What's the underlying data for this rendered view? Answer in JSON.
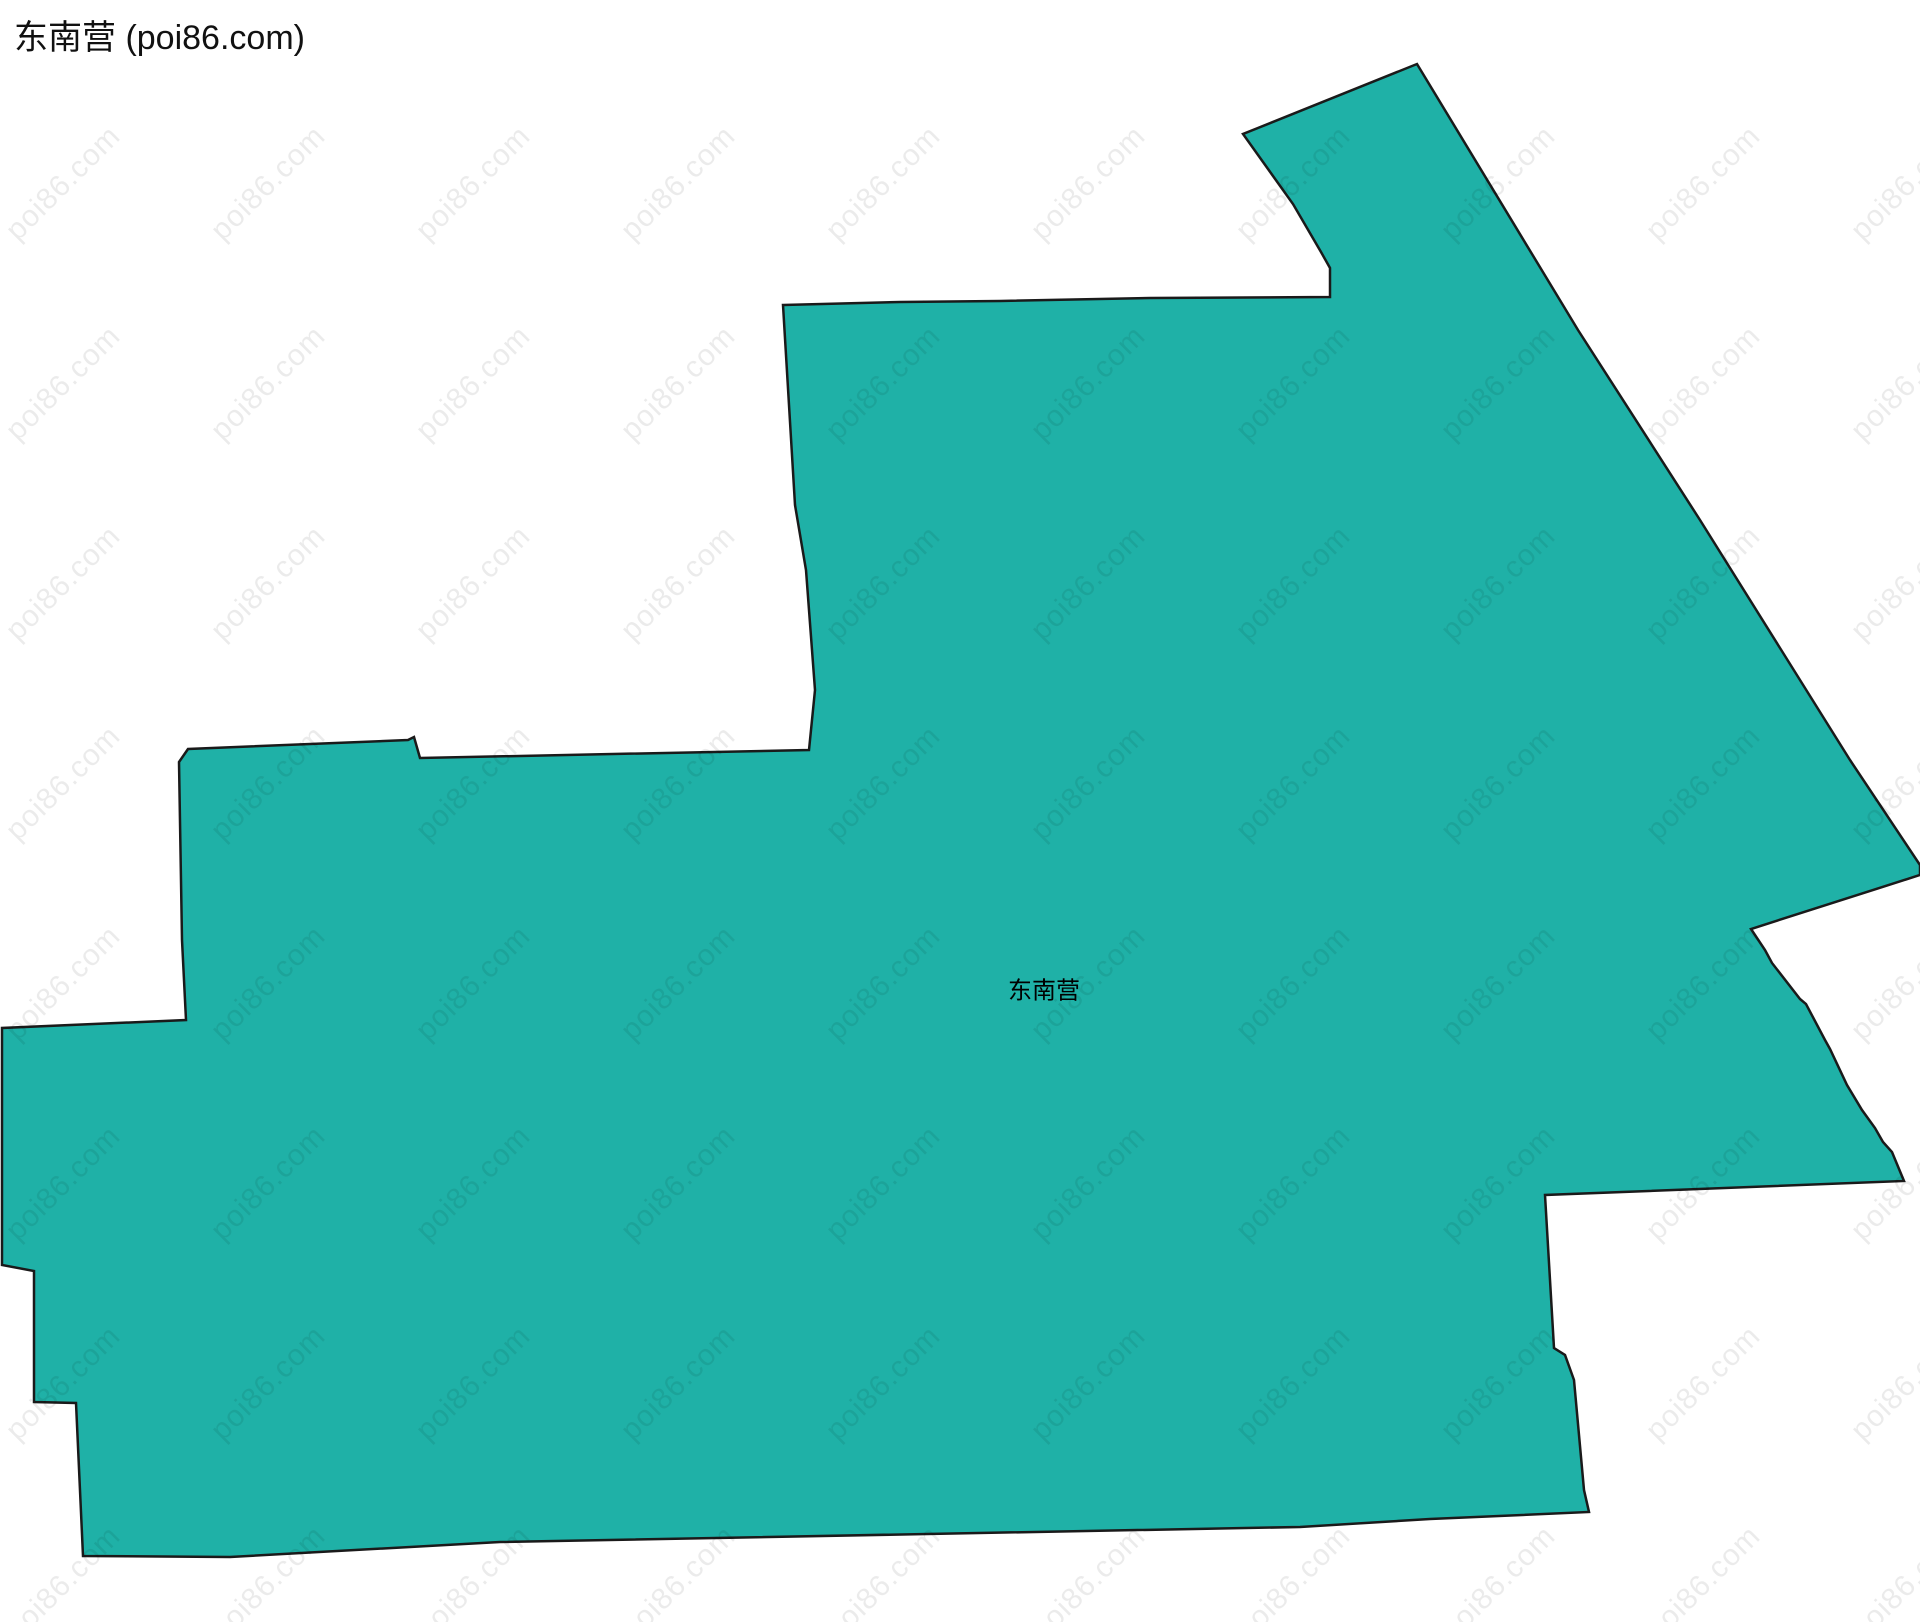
{
  "header": {
    "title": "东南营 (poi86.com)"
  },
  "map": {
    "region_name": "东南营",
    "label": {
      "text": "东南营"
    },
    "fill_color": "#1FB1A7",
    "stroke_color": "#1A1A1A",
    "polygon": [
      [
        783,
        305
      ],
      [
        900,
        302
      ],
      [
        1000,
        301
      ],
      [
        1150,
        298
      ],
      [
        1330,
        297
      ],
      [
        1330,
        268
      ],
      [
        1321,
        252
      ],
      [
        1293,
        204
      ],
      [
        1243,
        134
      ],
      [
        1417,
        64
      ],
      [
        1578,
        330
      ],
      [
        1700,
        520
      ],
      [
        1850,
        760
      ],
      [
        1920,
        865
      ],
      [
        1920,
        875
      ],
      [
        1751,
        929
      ],
      [
        1765,
        950
      ],
      [
        1772,
        963
      ],
      [
        1800,
        999
      ],
      [
        1806,
        1004
      ],
      [
        1825,
        1040
      ],
      [
        1830,
        1049
      ],
      [
        1847,
        1085
      ],
      [
        1862,
        1110
      ],
      [
        1875,
        1128
      ],
      [
        1883,
        1142
      ],
      [
        1892,
        1152
      ],
      [
        1904,
        1181
      ],
      [
        1545,
        1195
      ],
      [
        1554,
        1348
      ],
      [
        1565,
        1355
      ],
      [
        1574,
        1380
      ],
      [
        1584,
        1490
      ],
      [
        1589,
        1512
      ],
      [
        1430,
        1519
      ],
      [
        1300,
        1527
      ],
      [
        500,
        1542
      ],
      [
        230,
        1557
      ],
      [
        83,
        1556
      ],
      [
        76,
        1403
      ],
      [
        34,
        1402
      ],
      [
        34,
        1271
      ],
      [
        2,
        1265
      ],
      [
        2,
        1028
      ],
      [
        186,
        1020
      ],
      [
        182,
        940
      ],
      [
        179,
        762
      ],
      [
        188,
        749
      ],
      [
        408,
        740
      ],
      [
        414,
        737
      ],
      [
        420,
        758
      ],
      [
        809,
        750
      ],
      [
        815,
        690
      ],
      [
        806,
        570
      ],
      [
        795,
        505
      ]
    ]
  },
  "watermark": {
    "text": "poi86.com",
    "color": "rgba(0,0,0,0.08)"
  }
}
